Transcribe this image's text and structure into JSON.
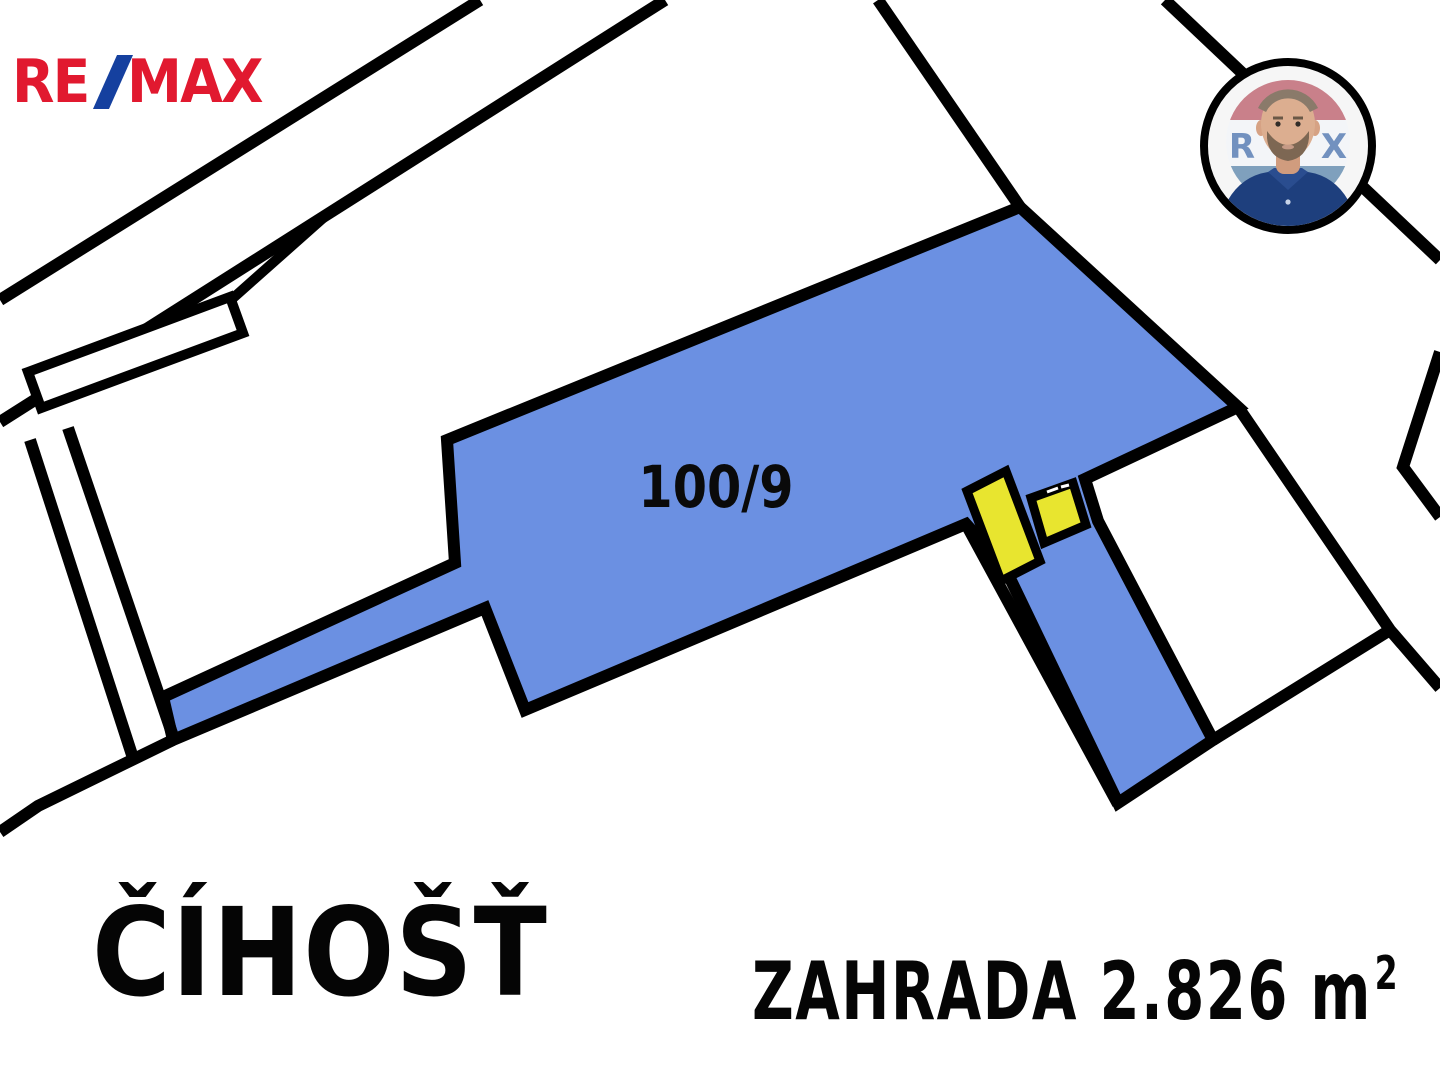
{
  "branding": {
    "logo": {
      "re": "RE",
      "slash": "/",
      "max": "MAX",
      "red": "#e1192f",
      "blue": "#15409f"
    }
  },
  "agent_avatar": {
    "letters": {
      "left": "R",
      "right": "X"
    },
    "colors": {
      "ring": "#000000",
      "balloon_red": "#c9808a",
      "balloon_blue": "#7fa0bd",
      "balloon_letters": "#7291bf",
      "shirt": "#1e3f7d",
      "skin": "#dcae90",
      "beard": "#7d6753",
      "hair": "#8a7a6a"
    }
  },
  "map": {
    "ink": "#000000",
    "parcel_fill": "#6b90e2",
    "building_fill": "#e8e52f",
    "parcel_label": {
      "text": "100/9",
      "x": 716,
      "y": 487
    },
    "shapes": [
      {
        "name": "parcel-100-9",
        "type": "polygon",
        "w": 12,
        "fill": "#6b90e2",
        "points": [
          [
            1020,
            207
          ],
          [
            1238,
            407
          ],
          [
            1085,
            479
          ],
          [
            1098,
            521
          ],
          [
            1213,
            740
          ],
          [
            1118,
            803
          ],
          [
            1005,
            568
          ],
          [
            966,
            524
          ],
          [
            525,
            710
          ],
          [
            485,
            608
          ],
          [
            173,
            740
          ],
          [
            163,
            697
          ],
          [
            455,
            563
          ],
          [
            447,
            440
          ]
        ]
      },
      {
        "name": "road-upper-left-line-1",
        "type": "polyline",
        "w": 12,
        "points": [
          [
            0,
            300
          ],
          [
            480,
            0
          ]
        ]
      },
      {
        "name": "road-upper-left-line-2",
        "type": "polyline",
        "w": 12,
        "points": [
          [
            0,
            422
          ],
          [
            665,
            0
          ]
        ]
      },
      {
        "name": "outbuilding-connector",
        "type": "polyline",
        "w": 10,
        "points": [
          [
            232,
            299
          ],
          [
            330,
            212
          ]
        ]
      },
      {
        "name": "outbuilding-parcel",
        "type": "polygon",
        "w": 10,
        "fill": "#ffffff",
        "points": [
          [
            28,
            372
          ],
          [
            230,
            297
          ],
          [
            243,
            333
          ],
          [
            41,
            408
          ]
        ]
      },
      {
        "name": "lane-left-line-1",
        "type": "polyline",
        "w": 12,
        "points": [
          [
            30,
            440
          ],
          [
            133,
            758
          ]
        ]
      },
      {
        "name": "lane-left-line-2",
        "type": "polyline",
        "w": 12,
        "points": [
          [
            68,
            428
          ],
          [
            175,
            742
          ]
        ]
      },
      {
        "name": "boundary-southwest",
        "type": "polyline",
        "w": 12,
        "points": [
          [
            0,
            832
          ],
          [
            38,
            806
          ],
          [
            173,
            740
          ]
        ]
      },
      {
        "name": "road-north-line-1",
        "type": "polyline",
        "w": 12,
        "points": [
          [
            878,
            0
          ],
          [
            1020,
            207
          ]
        ]
      },
      {
        "name": "road-north-line-2",
        "type": "polyline",
        "w": 12,
        "points": [
          [
            1165,
            0
          ],
          [
            1440,
            260
          ]
        ]
      },
      {
        "name": "road-east-kink",
        "type": "polyline",
        "w": 12,
        "points": [
          [
            1440,
            352
          ],
          [
            1403,
            467
          ],
          [
            1440,
            517
          ]
        ]
      },
      {
        "name": "road-east-line-1",
        "type": "polyline",
        "w": 12,
        "points": [
          [
            1238,
            407
          ],
          [
            1390,
            630
          ],
          [
            1440,
            688
          ]
        ]
      },
      {
        "name": "road-east-line-2",
        "type": "polyline",
        "w": 12,
        "points": [
          [
            1390,
            630
          ],
          [
            1213,
            740
          ]
        ]
      },
      {
        "name": "boundary-strip-west",
        "type": "polyline",
        "w": 12,
        "points": [
          [
            966,
            524
          ],
          [
            1118,
            804
          ]
        ]
      },
      {
        "name": "building-1",
        "type": "polygon",
        "w": 9,
        "fill": "#e8e52f",
        "points": [
          [
            967,
            491
          ],
          [
            1006,
            471
          ],
          [
            1040,
            561
          ],
          [
            1001,
            581
          ]
        ]
      },
      {
        "name": "building-2",
        "type": "polygon",
        "w": 9,
        "fill": "#e8e52f",
        "points": [
          [
            1031,
            498
          ],
          [
            1073,
            483
          ],
          [
            1086,
            525
          ],
          [
            1044,
            543
          ]
        ]
      },
      {
        "name": "building-2-door-mark-1",
        "type": "polyline",
        "w": 3,
        "stroke": "#ffffff",
        "points": [
          [
            1047,
            492
          ],
          [
            1058,
            488
          ]
        ]
      },
      {
        "name": "building-2-door-mark-2",
        "type": "polyline",
        "w": 3,
        "stroke": "#ffffff",
        "points": [
          [
            1061,
            487
          ],
          [
            1069,
            485
          ]
        ]
      }
    ]
  },
  "footer": {
    "locality": "ČÍHOŠŤ",
    "area_label": "ZAHRADA 2.826 m",
    "area_sup": "2"
  }
}
